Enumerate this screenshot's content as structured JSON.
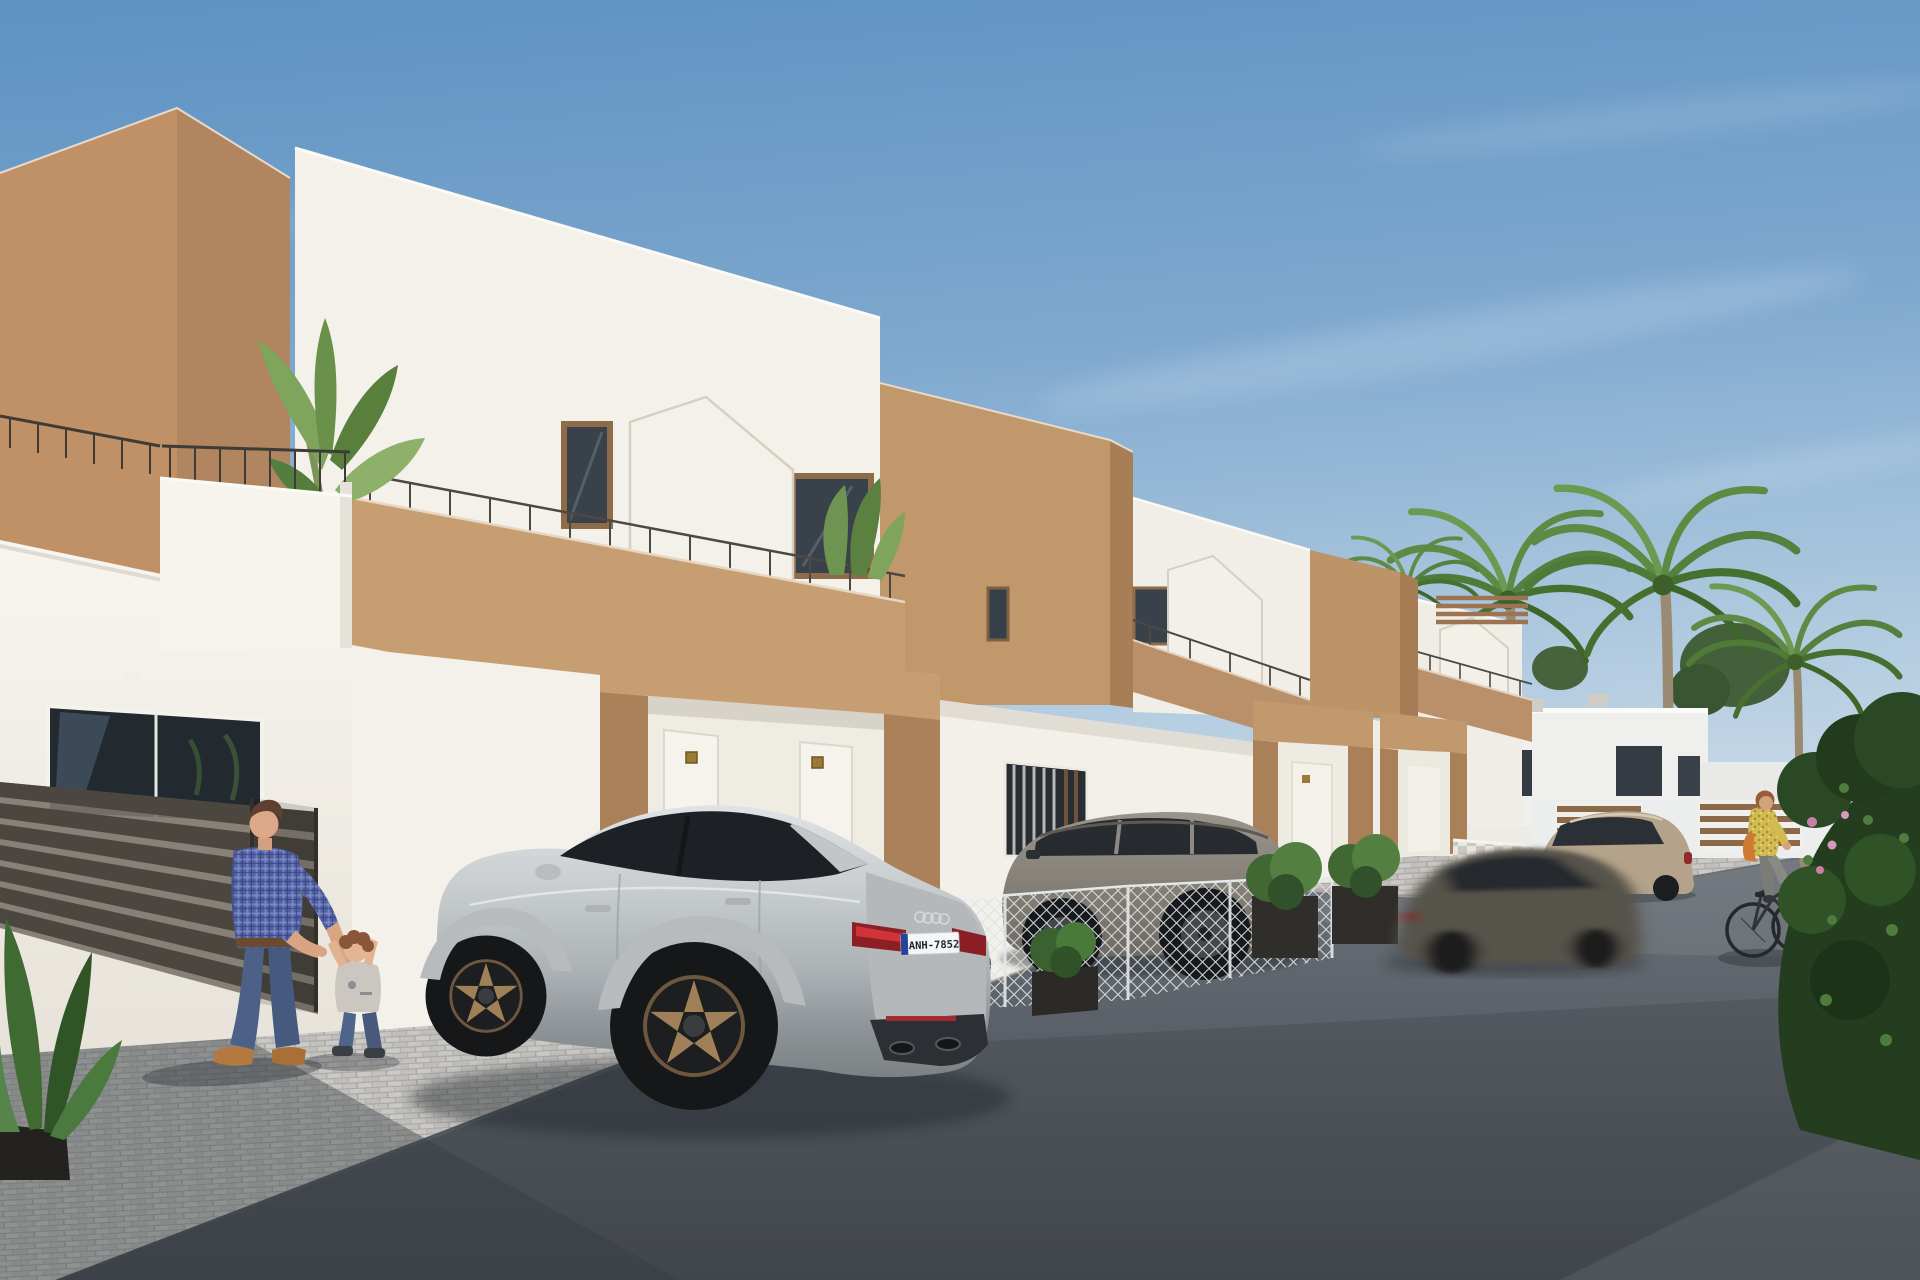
{
  "meta": {
    "kind": "photorealistic architectural render",
    "description": "Sunny street view of a row of new modern white-and-terracotta two-storey townhouses. A silver sportback is parked in a cobbled driveway, a grey SUV is parked behind a wire-mesh fence, a motion-blurred sedan drives past, a father plays with his toddler on the left and a woman cycles past palm trees on the right."
  },
  "sky": {
    "description": "clear blue sky with faint wispy clouds",
    "top_color": "#5d92c2",
    "horizon_color": "#c6d8e7"
  },
  "buildings": {
    "style": "modern flat-roofed townhouses, white stucco with terracotta-brown accent volumes",
    "features": [
      "terracotta corner monoliths",
      "roof terraces with brown parapets and thin metal railings",
      "house-shaped white privacy screens",
      "brown entrance porches with recessed white doors",
      "small gold door-number plaques",
      "glass sliding doors reflecting palms",
      "dark horizontal-slat fence",
      "wire mesh fence with planters",
      "checker-tiled low wall"
    ],
    "colors": {
      "white_wall": "#f4f1ea",
      "white_shade": "#e7e3da",
      "brown_lit": "#c79d72",
      "brown_front": "#a87f59",
      "window_glass": "#39424b"
    }
  },
  "background": {
    "items": [
      "distant white houses with dark windows",
      "tall palm trees",
      "leafy green trees",
      "brown slatted fence panels",
      "large dark-green bush with pink flowers"
    ]
  },
  "vehicles": {
    "audi": {
      "type": "silver sportback parked in driveway",
      "color": "#c4c9cb",
      "wheel_color": "bronze",
      "plate": "ANH-7852",
      "plate_band_color": "#27429c"
    },
    "suv": {
      "type": "grey SUV parked behind mesh fence",
      "color": "#858077"
    },
    "moving_sedan": {
      "type": "dark grey sedan driving past, motion blurred",
      "color": "#57524b"
    },
    "beige_suv": {
      "type": "champagne SUV parked further down the street",
      "color": "#b4a38a"
    }
  },
  "people": {
    "father": {
      "description": "man in blue plaid shirt, jeans and tan shoes playing with toddler",
      "shirt_color": "#5060a2"
    },
    "toddler": {
      "description": "toddler in grey t-shirt and jeans reaching up to hold hands"
    },
    "cyclist": {
      "description": "woman in yellow floral top with orange bag riding a bicycle",
      "top_color": "#d2bc52"
    }
  },
  "vegetation": {
    "items": [
      "banana plant on left balcony",
      "terrace shrub",
      "planter shrubs",
      "green hedge behind parked car",
      "houseplant in lower-left corner",
      "palm trees"
    ]
  },
  "ground": {
    "driveway": "light grey cobblestone pavers",
    "road": "dark asphalt",
    "lighting": "low sun from the left casting long soft shadows"
  }
}
